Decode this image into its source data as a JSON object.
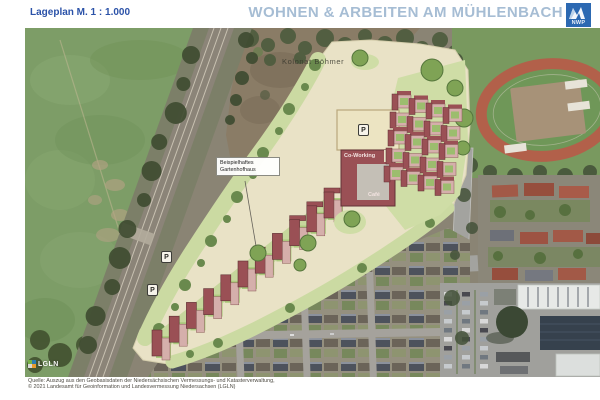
{
  "header": {
    "scale_label": "Lageplan M. 1 : 1.000",
    "title": "WOHNEN & ARBEITEN AM MÜHLENBACH",
    "logo_text": "NWP"
  },
  "map": {
    "labels": {
      "area_label": "Kolonat Böhmer",
      "callout_line1": "Beispielhaftes",
      "callout_line2": "Gartenhofhaus",
      "coworking": "Co-Working",
      "cafe": "Café",
      "parking_symbol": "P",
      "watermark": "LGLN"
    },
    "colors": {
      "plan_path_cream": "#e9e2c6",
      "plan_green": "#cbdaa2",
      "building_red": "#9a5055",
      "building_pink": "#d5afab",
      "field_green": "#7d9d67",
      "track_red": "#b2604a",
      "logo_blue": "#2c69b2",
      "title_blue": "#a6bdd4"
    }
  },
  "footer": {
    "attribution_line1": "Quelle: Auszug aus den Geobasisdaten der Niedersächsischen Vermessungs- und Katasterverwaltung,",
    "attribution_line2": "© 2021 Landesamt für Geoinformation und Landesvermessung Niedersachsen (LGLN)"
  }
}
